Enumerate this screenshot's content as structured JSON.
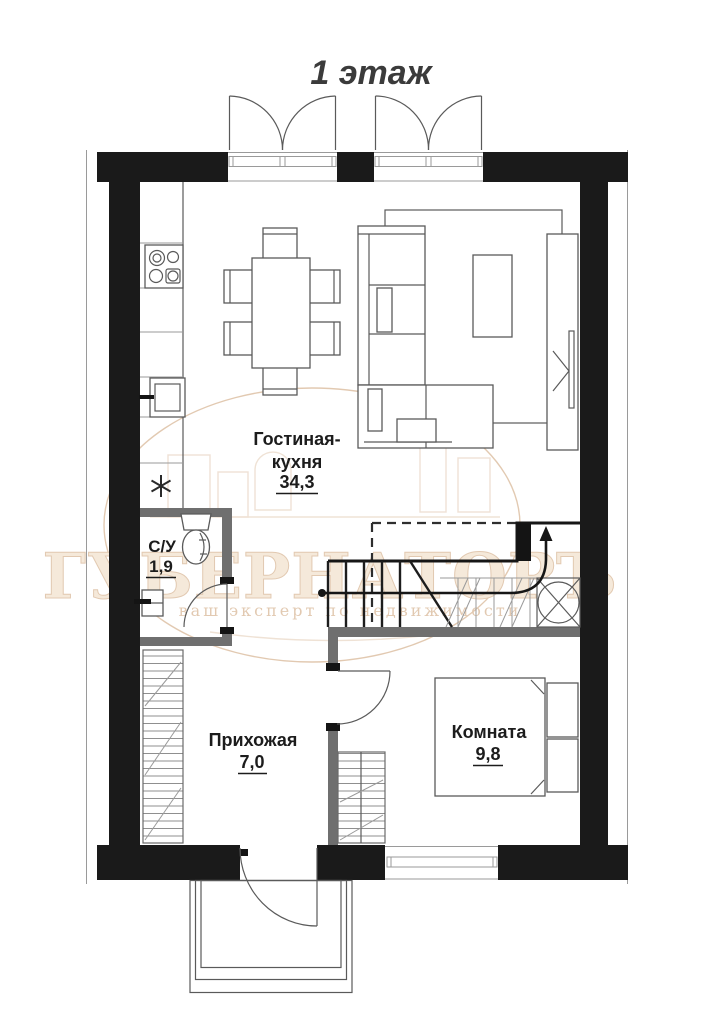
{
  "title": "1 этаж",
  "watermark": {
    "brand": "ГУБЕРНАТОРЪ",
    "tagline": "ваш эксперт по недвижимости"
  },
  "rooms": [
    {
      "id": "living-kitchen",
      "name_line1": "Гостиная-",
      "name_line2": "кухня",
      "area": "34,3"
    },
    {
      "id": "bathroom",
      "name": "С/У",
      "area": "1,9"
    },
    {
      "id": "hallway",
      "name": "Прихожая",
      "area": "7,0"
    },
    {
      "id": "room",
      "name": "Комната",
      "area": "9,8"
    }
  ],
  "symbols": [
    "double-french-door",
    "entrance-door",
    "interior-door",
    "window",
    "stairs-with-up-arrow",
    "toilet",
    "washbasin",
    "stove",
    "kitchen-sink",
    "dining-table-six-chairs",
    "corner-sofa",
    "coffee-table",
    "rug",
    "tv-cabinet",
    "double-bed",
    "wardrobe-hatched",
    "porch-steps",
    "asterisk-symbol"
  ],
  "colors": {
    "wall": "#1a1a1a",
    "iwall": "#6f6f6f",
    "line": "#5a5a5a",
    "thin": "#9a9a9a",
    "label": "#1c1c1c",
    "title": "#3b3b3b",
    "wm": "#bf8a55",
    "wmfill": "#eacfae"
  }
}
